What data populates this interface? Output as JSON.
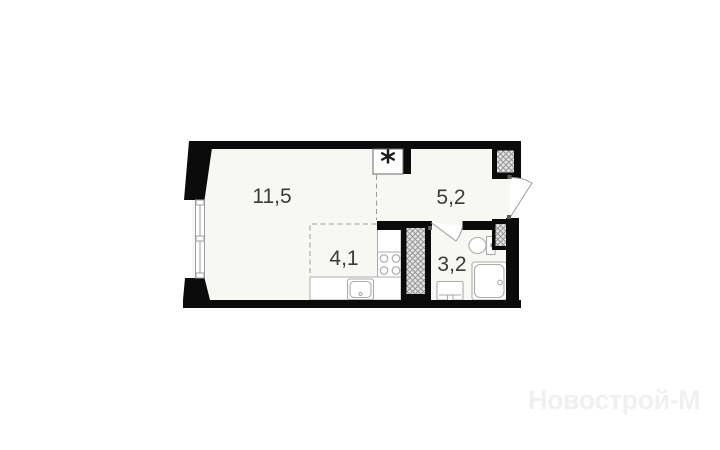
{
  "floorplan": {
    "type": "studio-apartment-floor-plan",
    "rooms": [
      {
        "id": "living-room",
        "area_label": "11,5"
      },
      {
        "id": "hallway",
        "area_label": "5,2"
      },
      {
        "id": "kitchen-zone",
        "area_label": "4,1"
      },
      {
        "id": "bathroom",
        "area_label": "3,2"
      }
    ],
    "vent_symbol": "*",
    "colors": {
      "wall": "#0b0b0b",
      "room_fill": "#f7f7f4",
      "fixture_fill": "#ffffff",
      "thin_line": "#9c9c9c",
      "fixture_line": "#ababab",
      "label": "#3b3b3b",
      "hatch_bg": "#e2e2e2",
      "hatch_line": "#8f8f8f",
      "watermark": "#f0f0f0"
    }
  },
  "watermark": {
    "text": "Новострой-М"
  }
}
